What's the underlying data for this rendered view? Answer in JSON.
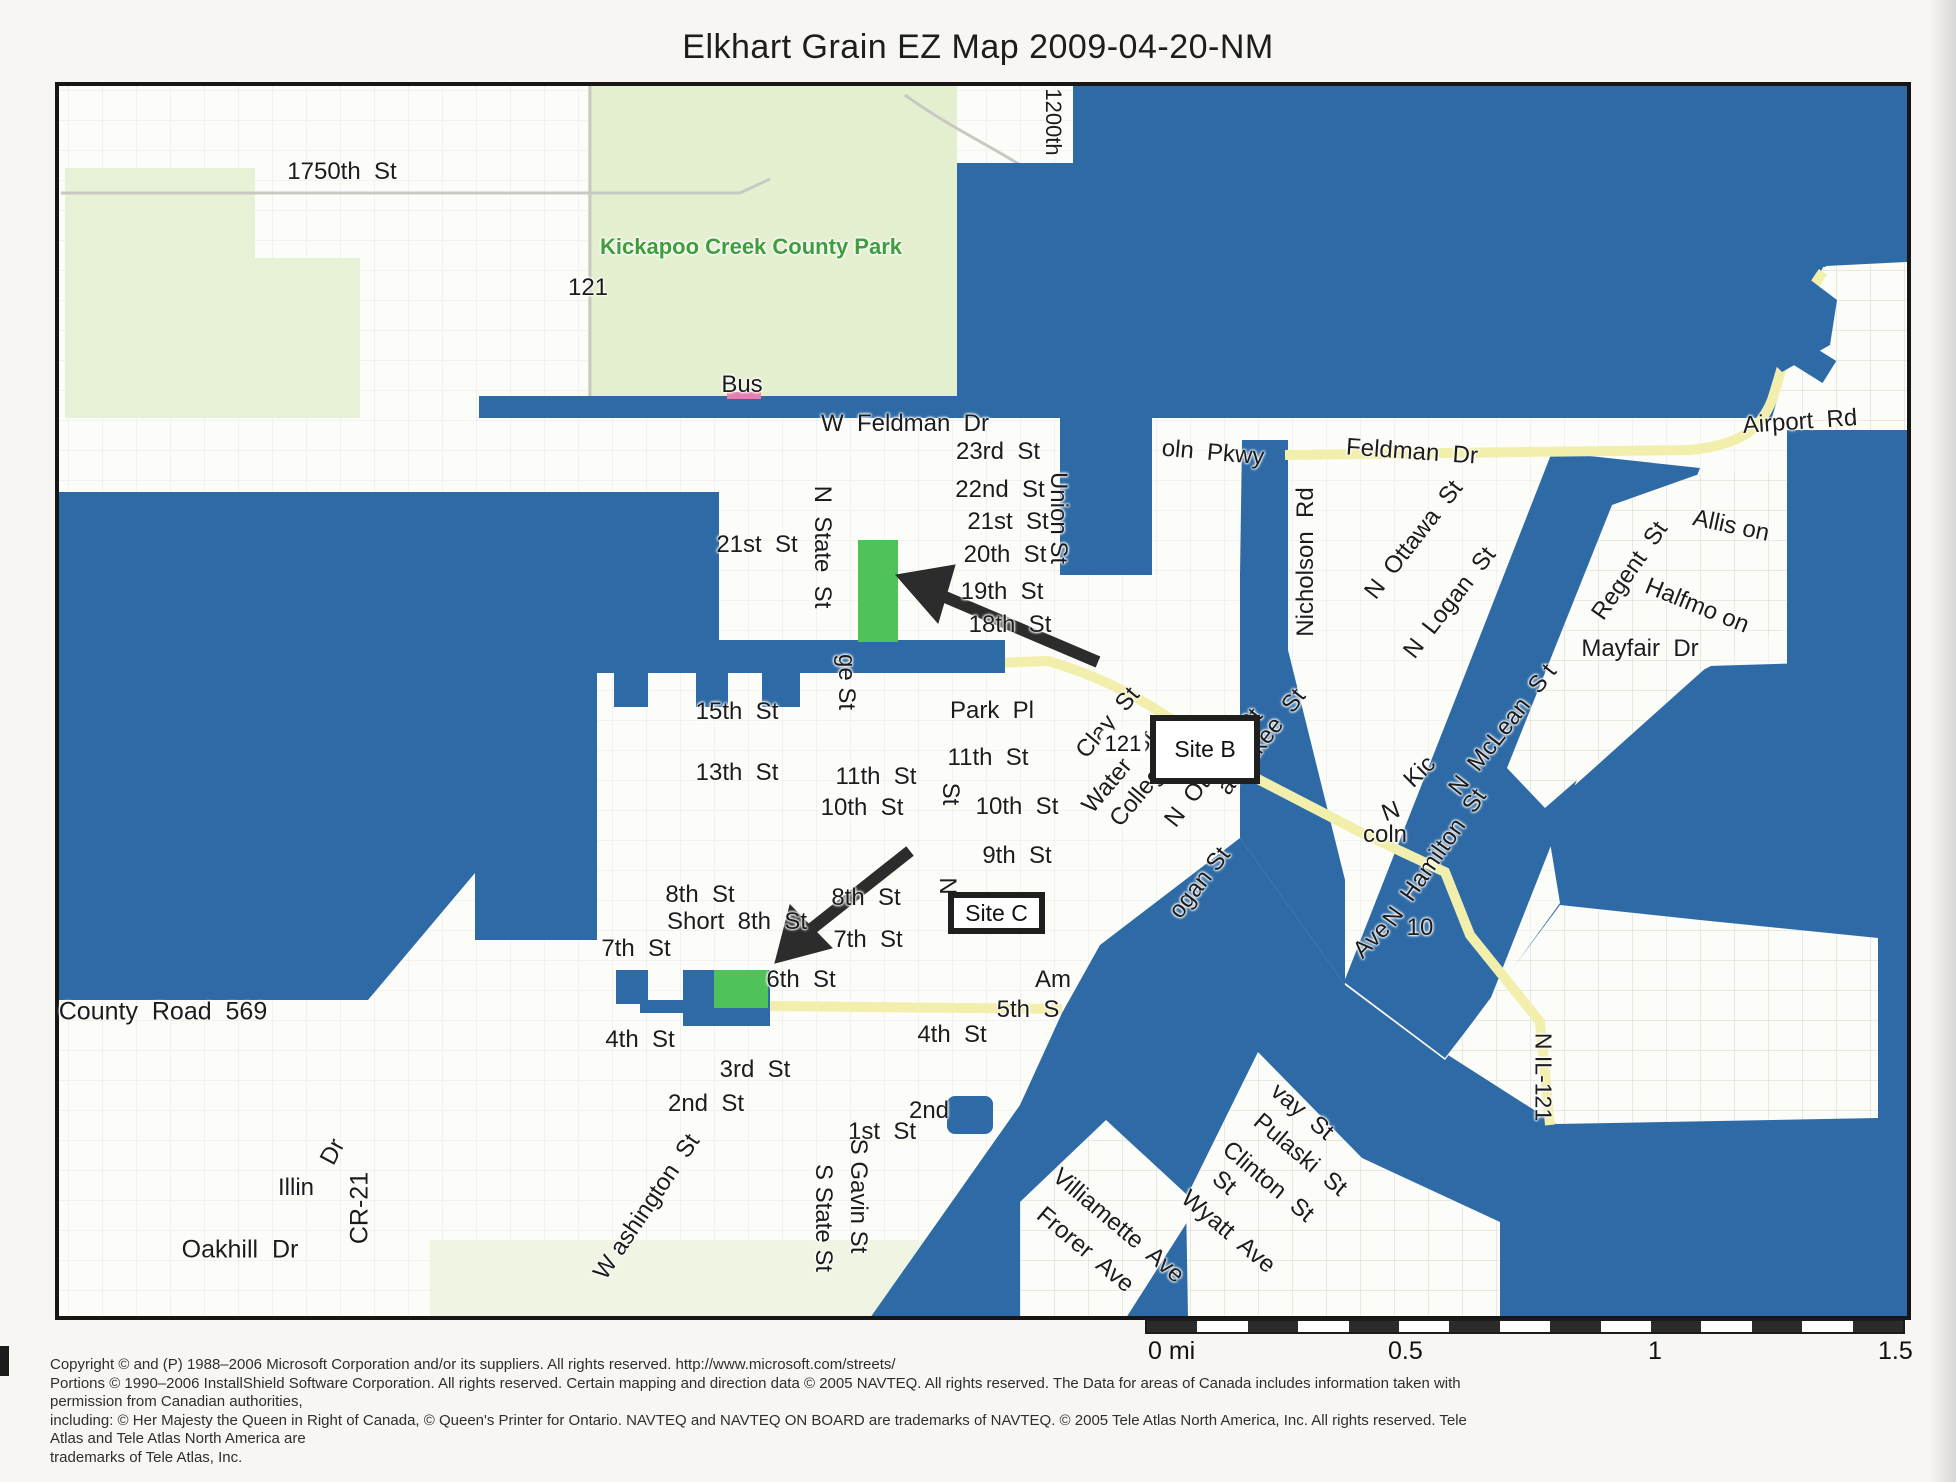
{
  "title": "Elkhart Grain EZ Map 2009-04-20-NM",
  "colors": {
    "redaction_blue": "#2e6ba6",
    "site_green": "#4fc35a",
    "park_green": "#e4efd0",
    "road_yellow": "#f2efad",
    "park_text_green": "#3f9e3b",
    "map_white": "#fcfcf9",
    "annotation_black": "#1f1f1f"
  },
  "sites": [
    {
      "label": "Site B"
    },
    {
      "label": "Site C"
    }
  ],
  "route_shield": {
    "label": "121"
  },
  "scale_bar": {
    "labels": [
      {
        "text": "0 mi",
        "x": 1148
      },
      {
        "text": "0.5",
        "x": 1388
      },
      {
        "text": "1",
        "x": 1648
      },
      {
        "text": "1.5",
        "x": 1878
      }
    ]
  },
  "copyright_lines": [
    "Copyright © and (P) 1988–2006 Microsoft Corporation and/or its suppliers. All rights reserved. http://www.microsoft.com/streets/",
    "Portions © 1990–2006 InstallShield Software Corporation. All rights reserved. Certain mapping and direction data © 2005 NAVTEQ. All rights reserved. The Data for areas of Canada includes information taken with permission from Canadian authorities,",
    "including: © Her Majesty the Queen in Right of Canada, © Queen's Printer for Ontario. NAVTEQ and NAVTEQ ON BOARD are trademarks of NAVTEQ. © 2005 Tele Atlas North America, Inc. All rights reserved. Tele Atlas and Tele Atlas North America are",
    "trademarks of Tele Atlas, Inc."
  ],
  "map_labels": [
    {
      "t": "1750th  St",
      "x": 342,
      "y": 172,
      "s": 24
    },
    {
      "t": "121",
      "x": 588,
      "y": 288,
      "s": 24
    },
    {
      "t": "Kickapoo Creek County Park",
      "x": 751,
      "y": 247,
      "s": 22,
      "c": "#3f9e3b",
      "w": 600
    },
    {
      "t": "Bus",
      "x": 742,
      "y": 385,
      "s": 24
    },
    {
      "t": "1200th",
      "x": 1053,
      "y": 122,
      "r": 90,
      "s": 22
    },
    {
      "t": "W  Feldman  Dr",
      "x": 905,
      "y": 424,
      "s": 24
    },
    {
      "t": "oln  Pkwy",
      "x": 1213,
      "y": 453,
      "r": 5,
      "s": 24
    },
    {
      "t": "23rd  St",
      "x": 998,
      "y": 452,
      "s": 24
    },
    {
      "t": "22nd  St",
      "x": 1000,
      "y": 490,
      "s": 24
    },
    {
      "t": "21st  St",
      "x": 1008,
      "y": 522,
      "s": 24
    },
    {
      "t": "20th  St",
      "x": 1005,
      "y": 555,
      "s": 24
    },
    {
      "t": "19th  St",
      "x": 1002,
      "y": 592,
      "s": 24
    },
    {
      "t": "18th  St",
      "x": 1010,
      "y": 625,
      "s": 24
    },
    {
      "t": "Union St",
      "x": 1058,
      "y": 518,
      "r": 90,
      "s": 24
    },
    {
      "t": "N  State  St",
      "x": 822,
      "y": 547,
      "r": 90,
      "s": 24
    },
    {
      "t": "21st  St",
      "x": 757,
      "y": 545,
      "s": 24
    },
    {
      "t": "Feldman  Dr",
      "x": 1412,
      "y": 452,
      "r": 4,
      "s": 24
    },
    {
      "t": "Airport  Rd",
      "x": 1800,
      "y": 422,
      "r": -4,
      "s": 24
    },
    {
      "t": "Nicholson  Rd",
      "x": 1306,
      "y": 562,
      "r": -90,
      "s": 24
    },
    {
      "t": "N  Ottawa  St",
      "x": 1414,
      "y": 540,
      "r": -52,
      "s": 24
    },
    {
      "t": "N  Logan  St",
      "x": 1450,
      "y": 603,
      "r": -52,
      "s": 24
    },
    {
      "t": "Regent  St",
      "x": 1630,
      "y": 571,
      "r": -55,
      "s": 24
    },
    {
      "t": "Allis on",
      "x": 1731,
      "y": 526,
      "r": 12,
      "s": 24
    },
    {
      "t": "Halfmo on",
      "x": 1697,
      "y": 606,
      "r": 22,
      "s": 24
    },
    {
      "t": "Mayfair  Dr",
      "x": 1640,
      "y": 649,
      "s": 24
    },
    {
      "t": "15th  St",
      "x": 737,
      "y": 712,
      "s": 24
    },
    {
      "t": "13th  St",
      "x": 737,
      "y": 773,
      "s": 24
    },
    {
      "t": "11th  St",
      "x": 876,
      "y": 777,
      "s": 24
    },
    {
      "t": "10th  St",
      "x": 862,
      "y": 808,
      "s": 24
    },
    {
      "t": "Park  Pl",
      "x": 992,
      "y": 711,
      "s": 24
    },
    {
      "t": "11th  St",
      "x": 988,
      "y": 758,
      "s": 24
    },
    {
      "t": "10th  St",
      "x": 1017,
      "y": 807,
      "s": 24
    },
    {
      "t": "9th  St",
      "x": 1017,
      "y": 856,
      "s": 24
    },
    {
      "t": "ge St",
      "x": 846,
      "y": 682,
      "r": 90,
      "s": 24
    },
    {
      "t": "St",
      "x": 950,
      "y": 794,
      "r": 90,
      "s": 24
    },
    {
      "t": "N",
      "x": 947,
      "y": 886,
      "r": 90,
      "s": 24
    },
    {
      "t": "Clay  St",
      "x": 1108,
      "y": 723,
      "r": -50,
      "s": 24
    },
    {
      "t": "Water  St",
      "x": 1119,
      "y": 772,
      "r": -50,
      "s": 24
    },
    {
      "t": "College  Ave",
      "x": 1158,
      "y": 772,
      "r": -50,
      "s": 24
    },
    {
      "t": "N  Ottawa  St",
      "x": 1214,
      "y": 768,
      "r": -52,
      "s": 24
    },
    {
      "t": "ankakee  St",
      "x": 1262,
      "y": 742,
      "r": -52,
      "s": 24
    },
    {
      "t": "Kic",
      "x": 1420,
      "y": 772,
      "r": -45,
      "s": 24
    },
    {
      "t": "N",
      "x": 1391,
      "y": 812,
      "r": -20,
      "s": 24
    },
    {
      "t": "coln",
      "x": 1385,
      "y": 835,
      "s": 24
    },
    {
      "t": "N  Hamilton  St",
      "x": 1435,
      "y": 858,
      "r": -55,
      "s": 24
    },
    {
      "t": "N  McLean  S t",
      "x": 1503,
      "y": 730,
      "r": -52,
      "s": 24
    },
    {
      "t": "10",
      "x": 1420,
      "y": 928,
      "s": 24
    },
    {
      "t": "Ave",
      "x": 1372,
      "y": 940,
      "r": -45,
      "s": 24
    },
    {
      "t": "ogan St",
      "x": 1200,
      "y": 883,
      "r": -52,
      "s": 24
    },
    {
      "t": "8th  St",
      "x": 700,
      "y": 895,
      "s": 24
    },
    {
      "t": "8th  St",
      "x": 866,
      "y": 898,
      "s": 24
    },
    {
      "t": "Short  8th  St",
      "x": 737,
      "y": 922,
      "s": 24
    },
    {
      "t": "7th  St",
      "x": 636,
      "y": 949,
      "s": 24
    },
    {
      "t": "7th  St",
      "x": 868,
      "y": 940,
      "s": 24
    },
    {
      "t": "6th  St",
      "x": 801,
      "y": 980,
      "s": 24
    },
    {
      "t": "Am",
      "x": 1053,
      "y": 980,
      "s": 24
    },
    {
      "t": "5th  S",
      "x": 1028,
      "y": 1010,
      "s": 24
    },
    {
      "t": "4th  St",
      "x": 952,
      "y": 1035,
      "s": 24
    },
    {
      "t": "4th  St",
      "x": 640,
      "y": 1040,
      "s": 24
    },
    {
      "t": "3rd  St",
      "x": 755,
      "y": 1070,
      "s": 24
    },
    {
      "t": "2nd  St",
      "x": 706,
      "y": 1104,
      "s": 24
    },
    {
      "t": "2nd",
      "x": 929,
      "y": 1111,
      "s": 24
    },
    {
      "t": "1st  St",
      "x": 882,
      "y": 1132,
      "s": 24
    },
    {
      "t": "S Gavin St",
      "x": 858,
      "y": 1196,
      "r": 90,
      "s": 24
    },
    {
      "t": "S State St",
      "x": 823,
      "y": 1218,
      "r": 90,
      "s": 24
    },
    {
      "t": "W ashington  St",
      "x": 647,
      "y": 1207,
      "r": -56,
      "s": 24
    },
    {
      "t": "County  Road  569",
      "x": 163,
      "y": 1012,
      "s": 25
    },
    {
      "t": "Illin",
      "x": 296,
      "y": 1188,
      "s": 24
    },
    {
      "t": "Dr",
      "x": 333,
      "y": 1152,
      "r": -62,
      "s": 24
    },
    {
      "t": "CR-21",
      "x": 360,
      "y": 1208,
      "r": -90,
      "s": 25
    },
    {
      "t": "Oakhill  Dr",
      "x": 240,
      "y": 1250,
      "s": 25
    },
    {
      "t": "N IL-121",
      "x": 1543,
      "y": 1077,
      "r": 90,
      "s": 23
    },
    {
      "t": "vay  St",
      "x": 1302,
      "y": 1112,
      "r": 40,
      "s": 24
    },
    {
      "t": "Pulaski  St",
      "x": 1300,
      "y": 1155,
      "r": 40,
      "s": 24
    },
    {
      "t": "Clinton  St",
      "x": 1268,
      "y": 1182,
      "r": 40,
      "s": 24
    },
    {
      "t": "St",
      "x": 1224,
      "y": 1183,
      "r": 40,
      "s": 24
    },
    {
      "t": "Wyatt  Ave",
      "x": 1228,
      "y": 1232,
      "r": 40,
      "s": 24
    },
    {
      "t": "Villiamette  Ave",
      "x": 1118,
      "y": 1226,
      "r": 40,
      "s": 24
    },
    {
      "t": "Frorer  Ave",
      "x": 1085,
      "y": 1250,
      "r": 40,
      "s": 24
    }
  ]
}
